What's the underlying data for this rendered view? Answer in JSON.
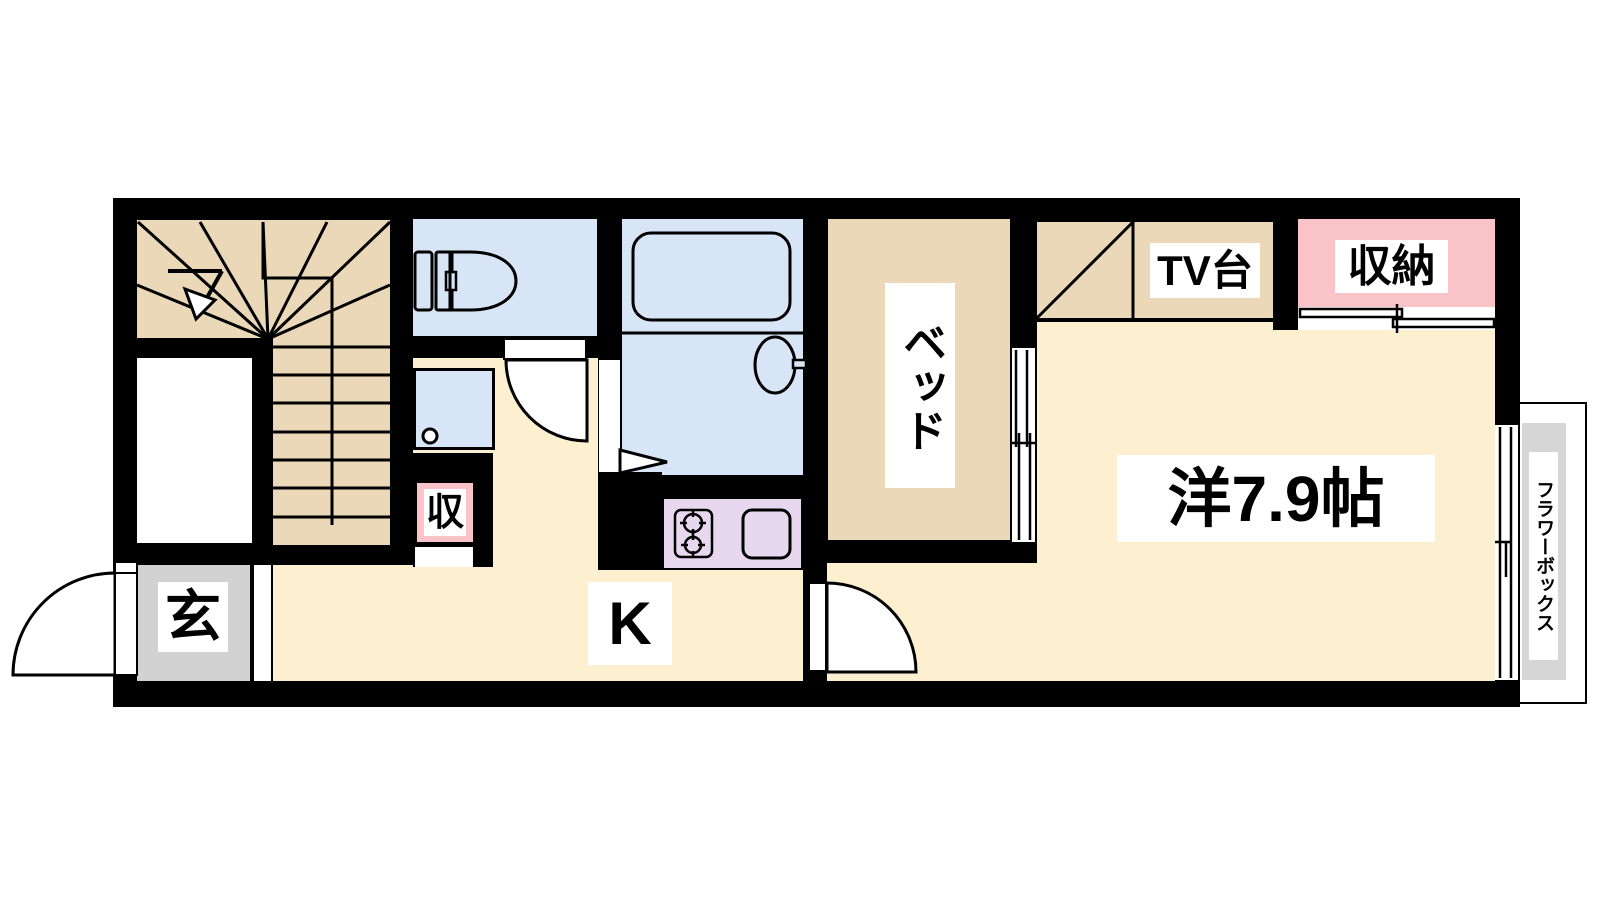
{
  "plan": {
    "type": "floor-plan",
    "labels": {
      "entrance": "玄",
      "kitchen": "K",
      "storage_small": "収",
      "storage": "収納",
      "tv_stand": "TV台",
      "bed": "ベッド",
      "western_room": "洋7.9帖",
      "flower_box": "フラワーボックス"
    },
    "rooms": [
      {
        "name": "stairs",
        "label": ""
      },
      {
        "name": "entrance",
        "label": "玄"
      },
      {
        "name": "toilet",
        "label": ""
      },
      {
        "name": "bathroom",
        "label": ""
      },
      {
        "name": "kitchen",
        "label": "K"
      },
      {
        "name": "small-storage",
        "label": "収"
      },
      {
        "name": "bed-space",
        "label": "ベッド"
      },
      {
        "name": "tv-stand-alcove",
        "label": "TV台"
      },
      {
        "name": "closet",
        "label": "収納"
      },
      {
        "name": "western-room",
        "label": "洋7.9帖",
        "size_tatami": 7.9
      },
      {
        "name": "flower-box",
        "label": "フラワーボックス"
      }
    ],
    "colors": {
      "wall": "#000000",
      "wood_floor": "#ead8b8",
      "room_floor": "#fdf0d0",
      "wet_area": "#d8e5f6",
      "storage_pink": "#f9c3c7",
      "kitchen_counter": "#e7d8f0",
      "entrance_gray": "#d2d2d2",
      "flower_box_gray": "#d6d6d6",
      "label_bg": "#ffffff"
    }
  }
}
